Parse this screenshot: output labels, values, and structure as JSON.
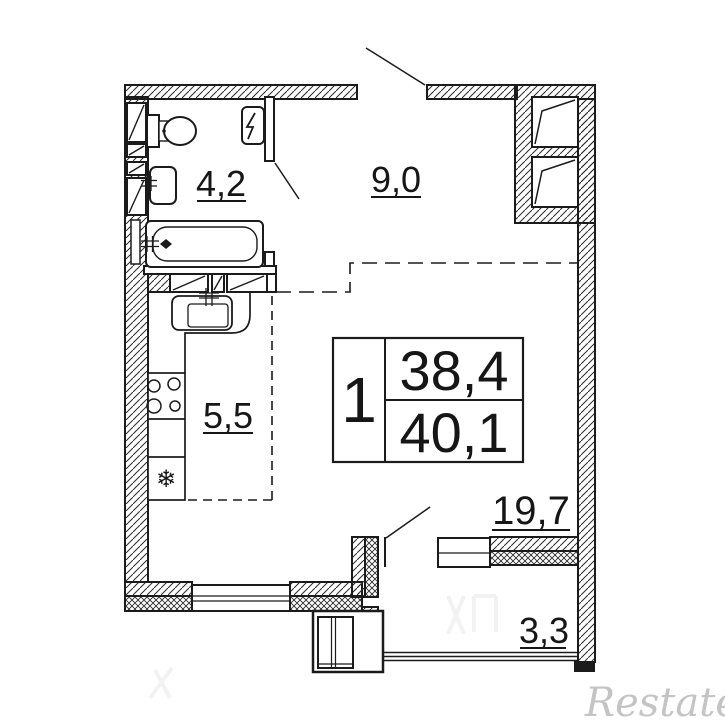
{
  "rooms": [
    {
      "name": "bathroom",
      "area": "4,2"
    },
    {
      "name": "hallway",
      "area": "9,0"
    },
    {
      "name": "kitchen",
      "area": "5,5"
    },
    {
      "name": "living-room",
      "area": "19,7"
    },
    {
      "name": "balcony",
      "area": "3,3"
    }
  ],
  "info_box": {
    "rooms_count": "1",
    "area_top": "38,4",
    "area_bottom": "40,1"
  },
  "watermark": {
    "brand": "Restate"
  },
  "fixtures": {
    "fridge_icon": "❄"
  },
  "colors": {
    "line": "#1b1b1b",
    "watermark": "#c4c4c4"
  }
}
